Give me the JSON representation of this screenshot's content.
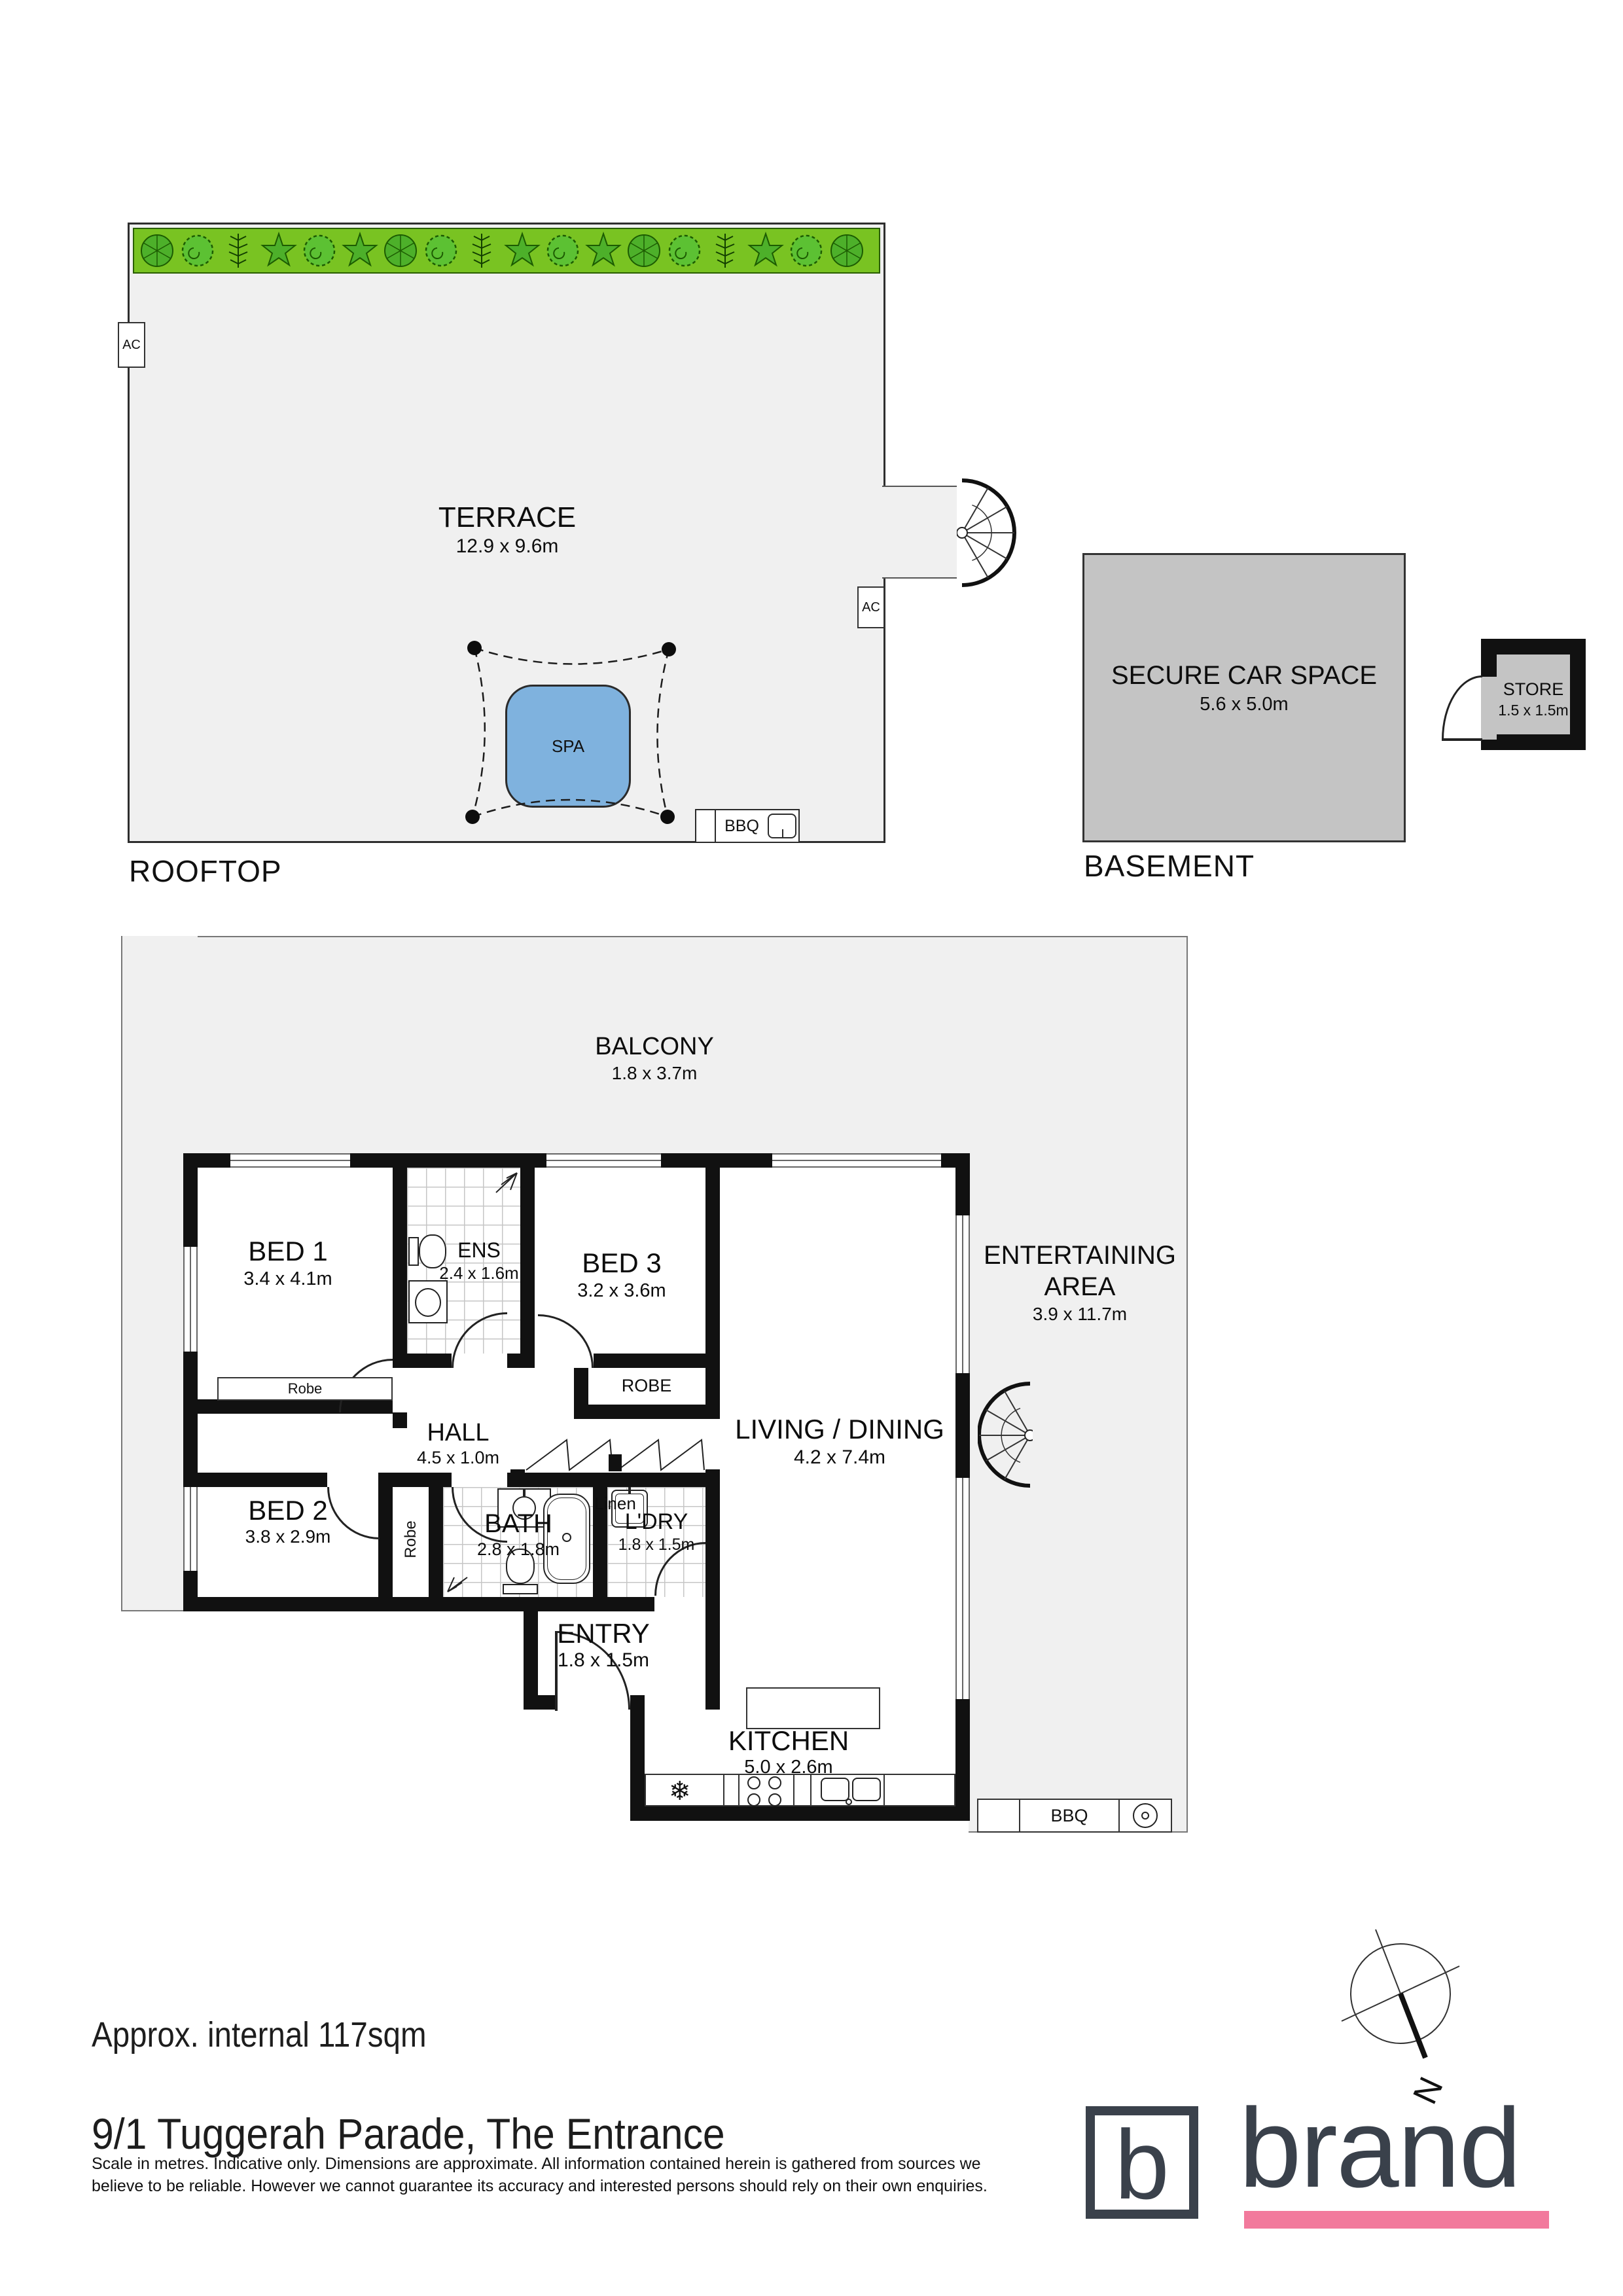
{
  "rooftop": {
    "caption": "ROOFTOP",
    "terrace_name": "TERRACE",
    "terrace_dims": "12.9 x 9.6m",
    "spa": "SPA",
    "bbq": "BBQ",
    "ac": "AC"
  },
  "basement": {
    "caption": "BASEMENT",
    "car_space_name": "SECURE CAR SPACE",
    "car_space_dims": "5.6 x 5.0m",
    "store_name": "STORE",
    "store_dims": "1.5 x 1.5m"
  },
  "floor": {
    "balcony_name": "BALCONY",
    "balcony_dims": "1.8 x 3.7m",
    "bed1_name": "BED 1",
    "bed1_dims": "3.4 x 4.1m",
    "ens_name": "ENS",
    "ens_dims": "2.4 x 1.6m",
    "bed3_name": "BED 3",
    "bed3_dims": "3.2 x 3.6m",
    "robe_bed3": "ROBE",
    "robe_bed1": "Robe",
    "robe_bed2": "Robe",
    "hall_name": "HALL",
    "hall_dims": "4.5 x 1.0m",
    "linen": "Linen",
    "living_name": "LIVING / DINING",
    "living_dims": "4.2 x 7.4m",
    "entertaining_line1": "ENTERTAINING",
    "entertaining_line2": "AREA",
    "entertaining_dims": "3.9 x 11.7m",
    "bed2_name": "BED 2",
    "bed2_dims": "3.8 x 2.9m",
    "bath_name": "BATH",
    "bath_dims": "2.8 x 1.8m",
    "ldry_name": "L'DRY",
    "ldry_dims": "1.8 x 1.5m",
    "entry_name": "ENTRY",
    "entry_dims": "1.8 x 1.5m",
    "kitchen_name": "KITCHEN",
    "kitchen_dims": "5.0 x 2.6m",
    "bbq": "BBQ"
  },
  "compass": {
    "north": "N"
  },
  "icons": {
    "fridge": "❄"
  },
  "footer": {
    "area": "Approx. internal 117sqm",
    "address": "9/1 Tuggerah Parade, The Entrance",
    "disclaimer_line1": "Scale in metres. Indicative only. Dimensions are approximate. All information contained herein is gathered from sources we",
    "disclaimer_line2": "believe to be reliable. However we cannot guarantee its accuracy and interested persons should rely on their own enquiries.",
    "brand_letter": "b",
    "brand_name": "brand"
  },
  "colors": {
    "garden_green": "#79c322",
    "spa_blue": "#7fb2de",
    "car_space_gray": "#c4c4c4",
    "floor_gray": "#f0f0f0",
    "brand_dark": "#3a414b",
    "brand_pink": "#f2799c"
  }
}
